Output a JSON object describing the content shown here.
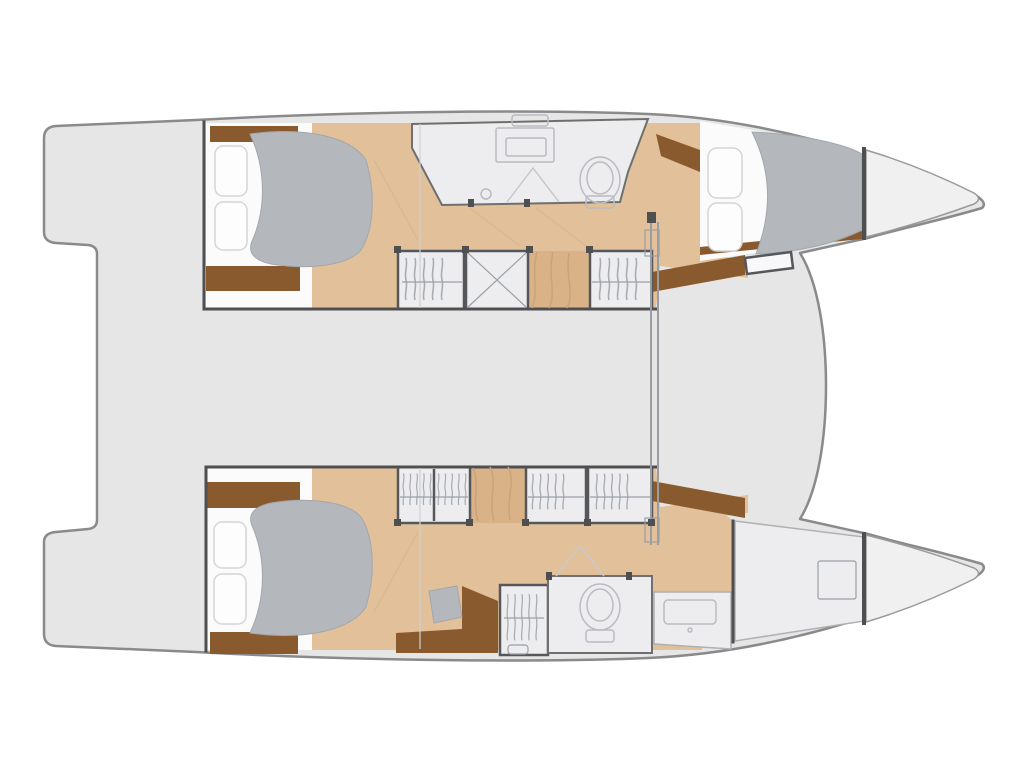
{
  "meta": {
    "title": "Catamaran interior deck plan",
    "type": "boat-floor-plan",
    "orientation": "bow-right-stern-left",
    "visible_text": []
  },
  "palette": {
    "background": "#ffffff",
    "hull_fill": "#e6e6e7",
    "forepeak_fill": "#f0f0f1",
    "wood_floor": "#e2c099",
    "wood_accent": "#d9b287",
    "white_area": "#fbfbfb",
    "dark_wood": "#8a5a2f",
    "pillow": "#fdfdfe",
    "soft_gray": "#b4b8bd",
    "room_fill": "#ededef",
    "fixture_fill": "#f8f8fa",
    "outline_gray": "#8a8a8a",
    "wall_dark": "#4f4f50"
  },
  "inventory": {
    "hulls": [
      {
        "name": "upper-hull",
        "spaces": [
          "transom-step",
          "aft-cabin-double-bed",
          "hanging-wardrobe",
          "x-storage-locker",
          "staircase",
          "bathroom-with-shower-toilet-sink",
          "forward-cabin-double-bed",
          "forepeak-locker"
        ]
      },
      {
        "name": "lower-hull",
        "spaces": [
          "transom-step",
          "aft-cabin-double-bed",
          "staircase",
          "hanging-wardrobes",
          "vanity-desk-with-stool",
          "bathroom-with-shower-toilet",
          "washbasin-counter",
          "forward-compartment-with-deck-hatch",
          "forepeak-locker"
        ]
      }
    ],
    "center": [
      "aft-cockpit-platform",
      "bridge-deck",
      "mast-beam",
      "foredeck",
      "trampoline-gap"
    ],
    "fixtures": [
      "bed",
      "pillows",
      "duvet",
      "toilet",
      "sink",
      "shower-marker",
      "hanging-clothes-rail",
      "deck-hatch",
      "window-hatch",
      "stool",
      "step-box"
    ]
  }
}
